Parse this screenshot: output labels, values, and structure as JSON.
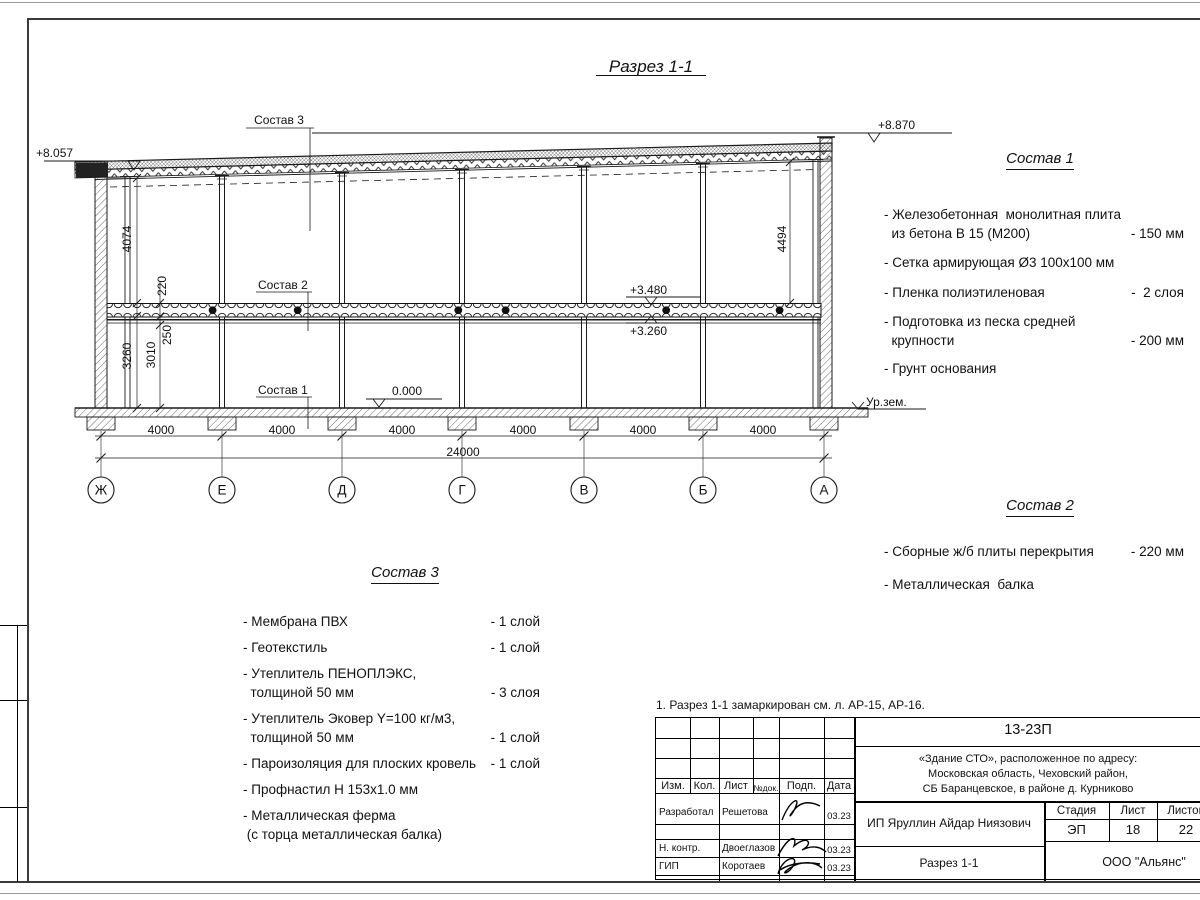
{
  "drawing": {
    "title": "Разрез 1-1",
    "elevations": {
      "roof_left": "+8.057",
      "roof_right": "+8.870",
      "slab_top": "+3.480",
      "slab_bottom": "+3.260",
      "floor": "0.000",
      "ground": "Ур.зем."
    },
    "dims": {
      "upper_height": "4074",
      "slab_thickness": "220",
      "beam_height": "250",
      "lower_height_a": "3260",
      "lower_height_b": "3010",
      "upper_height_right": "4494",
      "bay": "4000",
      "total": "24000"
    },
    "grid": [
      "Ж",
      "Е",
      "Д",
      "Г",
      "В",
      "Б",
      "А"
    ],
    "callouts": {
      "c1": "Состав 1",
      "c2": "Состав 2",
      "c3": "Состав 3"
    }
  },
  "sostav1": {
    "heading": "Состав 1",
    "items": [
      {
        "text": "- Железобетонная  монолитная плита\n  из бетона В 15 (М200)",
        "value": "- 150 мм"
      },
      {
        "text": "- Сетка армирующая Ø3 100х100 мм",
        "value": ""
      },
      {
        "text": "- Пленка полиэтиленовая",
        "value": "-  2 слоя"
      },
      {
        "text": "- Подготовка из песка средней\n  крупности",
        "value": "- 200 мм"
      },
      {
        "text": "- Грунт основания",
        "value": ""
      }
    ]
  },
  "sostav2": {
    "heading": "Состав 2",
    "items": [
      {
        "text": "- Сборные ж/б плиты перекрытия",
        "value": "- 220 мм"
      },
      {
        "text": "- Металлическая  балка",
        "value": ""
      }
    ]
  },
  "sostav3": {
    "heading": "Состав 3",
    "items": [
      {
        "text": "- Мембрана ПВХ",
        "value": "- 1 слой"
      },
      {
        "text": "- Геотекстиль",
        "value": "- 1 слой"
      },
      {
        "text": "- Утеплитель ПЕНОПЛЭКС,\n  толщиной 50 мм",
        "value": "- 3 слоя"
      },
      {
        "text": "- Утеплитель Эковер Y=100 кг/м3,\n  толщиной 50 мм",
        "value": "- 1 слой"
      },
      {
        "text": "- Пароизоляция для плоских кровель",
        "value": "- 1 слой"
      },
      {
        "text": "- Профнастил Н 153х1.0 мм",
        "value": ""
      },
      {
        "text": "- Металлическая ферма\n (с торца металлическая балка)",
        "value": ""
      }
    ]
  },
  "note": {
    "text": "1. Разрез 1-1 замаркирован см. л. АР-15, АР-16."
  },
  "titleblock": {
    "doc_code": "13-23П",
    "project": "«Здание СТО», расположенное по адресу:\nМосковская область, Чеховский район,\nСБ Баранцевское, в районе д. Курниково",
    "cols": [
      "Изм.",
      "Кол.",
      "Лист",
      "№док.",
      "Подп.",
      "Дата"
    ],
    "rows": [
      {
        "role": "Разработал",
        "name": "Решетова",
        "date": "03.23"
      },
      {
        "role": "Н. контр.",
        "name": "Двоеглазов",
        "date": "03.23"
      },
      {
        "role": "ГИП",
        "name": "Коротаев",
        "date": "03.23"
      }
    ],
    "client": "ИП Яруллин Айдар Ниязович",
    "stage_label": "Стадия",
    "sheet_label": "Лист",
    "sheets_label": "Листов",
    "stage": "ЭП",
    "sheet": "18",
    "sheets": "22",
    "sheet_title": "Разрез 1-1",
    "company": "ООО \"Альянс\""
  }
}
